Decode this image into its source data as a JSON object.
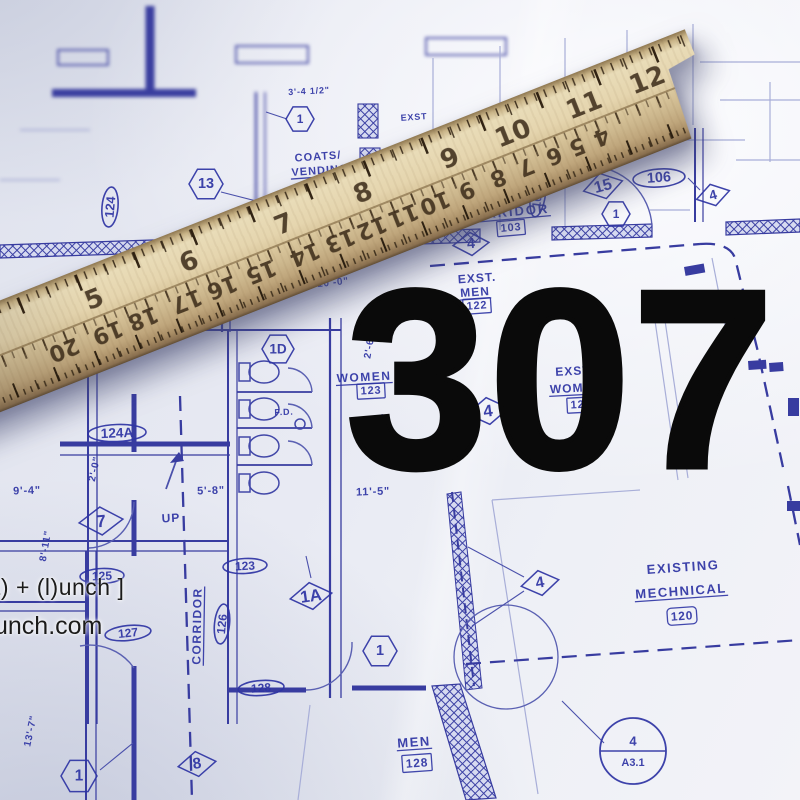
{
  "overlay": {
    "big_number": "307",
    "watermark": {
      "line1": "t) + (l)unch ]",
      "line2": "unch.com"
    }
  },
  "colors": {
    "paper": "#e8eaf3",
    "line_blue": "#383ca0",
    "faint_blue": "#a8aed8",
    "label_ink": "#2e34a4",
    "ruler_wood": "#d9c69c",
    "big_number": "#0a0a0a"
  },
  "ruler": {
    "top_scale": {
      "numbers": [
        "5",
        "6",
        "7",
        "8",
        "9",
        "10",
        "11",
        "12"
      ],
      "positions_pct": [
        23,
        35,
        47,
        57,
        68,
        76,
        85,
        93
      ]
    },
    "bottom_scale": {
      "numbers": [
        "20",
        "19",
        "18",
        "17",
        "16",
        "15",
        "14",
        "13",
        "12",
        "11",
        "10",
        "9",
        "8",
        "7",
        "6",
        "5",
        "4"
      ],
      "positions_pct": [
        17.5,
        23,
        27.5,
        33,
        37.5,
        42.5,
        48,
        52.5,
        56.5,
        60.5,
        64.5,
        68.5,
        72.5,
        76,
        79.5,
        82.5,
        85.5
      ]
    }
  },
  "blueprint": {
    "labels": [
      {
        "name": "label-corridor-103",
        "text": "CORRIDOR",
        "x": 506,
        "y": 212,
        "rot": -5,
        "size": 13,
        "u": true,
        "sp": 2
      },
      {
        "name": "num-corridor-103",
        "text": "103",
        "x": 511,
        "y": 228,
        "rot": -5,
        "size": 11,
        "box": true
      },
      {
        "name": "label-coats",
        "text": "COATS/",
        "x": 318,
        "y": 157,
        "rot": -4,
        "size": 11,
        "sp": 1
      },
      {
        "name": "label-vending",
        "text": "VENDING",
        "x": 320,
        "y": 171,
        "rot": -4,
        "size": 11,
        "u": true,
        "sp": 1
      },
      {
        "name": "label-exst",
        "text": "EXST.",
        "x": 477,
        "y": 278,
        "rot": -4,
        "size": 12,
        "sp": 1
      },
      {
        "name": "label-exst-men",
        "text": "MEN",
        "x": 475,
        "y": 292,
        "rot": -4,
        "size": 12,
        "u": true,
        "sp": 1
      },
      {
        "name": "num-exst-men-122",
        "text": "122",
        "x": 477,
        "y": 306,
        "rot": -4,
        "size": 11,
        "box": true
      },
      {
        "name": "label-women",
        "text": "WOMEN",
        "x": 364,
        "y": 377,
        "rot": -3,
        "size": 12,
        "u": true,
        "sp": 1.5
      },
      {
        "name": "num-women-123",
        "text": "123",
        "x": 371,
        "y": 391,
        "rot": -3,
        "size": 11,
        "box": true
      },
      {
        "name": "label-exst-w",
        "text": "EXST",
        "x": 573,
        "y": 371,
        "rot": -3,
        "size": 12,
        "sp": 1
      },
      {
        "name": "label-wom-w",
        "text": "WOMEN",
        "x": 576,
        "y": 388,
        "rot": -3,
        "size": 12,
        "u": true,
        "sp": 1
      },
      {
        "name": "num-wom-124",
        "text": "124",
        "x": 581,
        "y": 405,
        "rot": -3,
        "size": 11,
        "box": true
      },
      {
        "name": "label-existing",
        "text": "EXISTING",
        "x": 683,
        "y": 567,
        "rot": -4,
        "size": 13,
        "sp": 1.5
      },
      {
        "name": "label-mechnical",
        "text": "MECHNICAL",
        "x": 681,
        "y": 591,
        "rot": -4,
        "size": 13,
        "u": true,
        "sp": 1.5
      },
      {
        "name": "num-mech-120",
        "text": "120",
        "x": 682,
        "y": 616,
        "rot": -4,
        "size": 12,
        "box": true,
        "round": true
      },
      {
        "name": "label-men-128",
        "text": "MEN",
        "x": 414,
        "y": 742,
        "rot": -4,
        "size": 13,
        "u": true,
        "sp": 1.5
      },
      {
        "name": "num-men-128",
        "text": "128",
        "x": 417,
        "y": 763,
        "rot": -4,
        "size": 12,
        "box": true
      },
      {
        "name": "label-corridor-126",
        "text": "CORRIDOR",
        "x": 197,
        "y": 626,
        "rot": -89,
        "size": 12,
        "u": true,
        "sp": 1.5
      },
      {
        "name": "label-up",
        "text": "UP",
        "x": 171,
        "y": 518,
        "rot": -3,
        "size": 12,
        "sp": 1
      },
      {
        "name": "label-fd",
        "text": "F.D.",
        "x": 284,
        "y": 412,
        "rot": -2,
        "size": 9
      },
      {
        "name": "label-exst-small",
        "text": "EXST",
        "x": 414,
        "y": 117,
        "rot": -4,
        "size": 9
      },
      {
        "name": "dim-9-4",
        "text": "9'-4\"",
        "x": 27,
        "y": 491,
        "rot": -2,
        "size": 11
      },
      {
        "name": "dim-2-0",
        "text": "2'-0\"",
        "x": 95,
        "y": 469,
        "rot": -78,
        "size": 10
      },
      {
        "name": "dim-8-11",
        "text": "8'-11\"",
        "x": 46,
        "y": 546,
        "rot": -80,
        "size": 10
      },
      {
        "name": "dim-5-8",
        "text": "5'-8\"",
        "x": 211,
        "y": 491,
        "rot": -2,
        "size": 11
      },
      {
        "name": "dim-13-7",
        "text": "13'-7\"",
        "x": 31,
        "y": 731,
        "rot": -78,
        "size": 10
      },
      {
        "name": "dim-11-5",
        "text": "11'-5\"",
        "x": 373,
        "y": 492,
        "rot": -2,
        "size": 11
      },
      {
        "name": "dim-2-6-a",
        "text": "2'-6\"",
        "x": 370,
        "y": 346,
        "rot": -80,
        "size": 10
      },
      {
        "name": "dim-2-6-b",
        "text": "2'-6\"",
        "x": 384,
        "y": 426,
        "rot": -80,
        "size": 10
      },
      {
        "name": "dim-10-0",
        "text": "10'-0\"",
        "x": 333,
        "y": 283,
        "rot": -6,
        "size": 10
      },
      {
        "name": "dim-3-4-half",
        "text": "3'-4 1/2\"",
        "x": 309,
        "y": 91,
        "rot": -3,
        "size": 9
      }
    ],
    "markers": [
      {
        "name": "room-tag-124",
        "shape": "oval",
        "text": "124",
        "x": 110,
        "y": 207,
        "rot": -85,
        "w": 40,
        "h": 16
      },
      {
        "name": "room-tag-124A",
        "shape": "oval",
        "text": "124A",
        "x": 117,
        "y": 433,
        "rot": -2,
        "w": 58,
        "h": 17
      },
      {
        "name": "room-tag-125",
        "shape": "oval",
        "text": "125",
        "x": 102,
        "y": 576,
        "rot": -2,
        "w": 44,
        "h": 15
      },
      {
        "name": "room-tag-123",
        "shape": "oval",
        "text": "123",
        "x": 245,
        "y": 566,
        "rot": -3,
        "w": 44,
        "h": 15
      },
      {
        "name": "room-tag-127",
        "shape": "oval",
        "text": "127",
        "x": 128,
        "y": 633,
        "rot": -6,
        "w": 46,
        "h": 15
      },
      {
        "name": "room-tag-126",
        "shape": "oval",
        "text": "126",
        "x": 222,
        "y": 624,
        "rot": -84,
        "w": 40,
        "h": 15
      },
      {
        "name": "room-tag-128",
        "shape": "oval",
        "text": "128",
        "x": 261,
        "y": 688,
        "rot": -4,
        "w": 46,
        "h": 15
      },
      {
        "name": "room-tag-106",
        "shape": "oval",
        "text": "106",
        "x": 659,
        "y": 178,
        "rot": -4,
        "w": 52,
        "h": 18
      },
      {
        "name": "room-tag-106A",
        "shape": "oval",
        "text": "106A",
        "x": 538,
        "y": 194,
        "rot": -82,
        "w": 46,
        "h": 15
      },
      {
        "name": "keynote-15",
        "shape": "diamond",
        "text": "15",
        "x": 603,
        "y": 186,
        "rot": -15,
        "w": 40,
        "h": 26
      },
      {
        "name": "keynote-4-a",
        "shape": "diamond",
        "text": "4",
        "x": 713,
        "y": 195,
        "rot": -15,
        "w": 34,
        "h": 22
      },
      {
        "name": "keynote-4-b",
        "shape": "diamond",
        "text": "4",
        "x": 540,
        "y": 583,
        "rot": -10,
        "w": 38,
        "h": 25
      },
      {
        "name": "keynote-4-c",
        "shape": "diamond",
        "text": "4",
        "x": 488,
        "y": 411,
        "rot": -8,
        "w": 42,
        "h": 27
      },
      {
        "name": "keynote-4-d",
        "shape": "diamond",
        "text": "4",
        "x": 471,
        "y": 244,
        "rot": -5,
        "w": 36,
        "h": 23
      },
      {
        "name": "keynote-8",
        "shape": "diamond",
        "text": "8",
        "x": 197,
        "y": 764,
        "rot": -8,
        "w": 38,
        "h": 25
      },
      {
        "name": "keynote-7",
        "shape": "diamond",
        "text": "7",
        "x": 101,
        "y": 521,
        "rot": -5,
        "w": 44,
        "h": 28
      },
      {
        "name": "keynote-1A",
        "shape": "diamond",
        "text": "1A",
        "x": 311,
        "y": 596,
        "rot": -8,
        "w": 42,
        "h": 27
      },
      {
        "name": "doortag-1-top",
        "shape": "hex",
        "text": "1",
        "x": 300,
        "y": 119,
        "r": 14
      },
      {
        "name": "doortag-13",
        "shape": "hex",
        "text": "13",
        "x": 206,
        "y": 184,
        "r": 17
      },
      {
        "name": "doortag-1D",
        "shape": "hex",
        "text": "1D",
        "x": 278,
        "y": 349,
        "r": 16
      },
      {
        "name": "doortag-1-mid",
        "shape": "hex",
        "text": "1",
        "x": 616,
        "y": 214,
        "r": 14
      },
      {
        "name": "doortag-1-low",
        "shape": "hex",
        "text": "1",
        "x": 380,
        "y": 651,
        "r": 17
      },
      {
        "name": "doortag-1-bl",
        "shape": "hex",
        "text": "1",
        "x": 79,
        "y": 776,
        "r": 18
      },
      {
        "name": "section-marker-A31",
        "shape": "circle2",
        "text": "4",
        "sub": "A3.1",
        "x": 633,
        "y": 751,
        "r": 33
      }
    ]
  }
}
